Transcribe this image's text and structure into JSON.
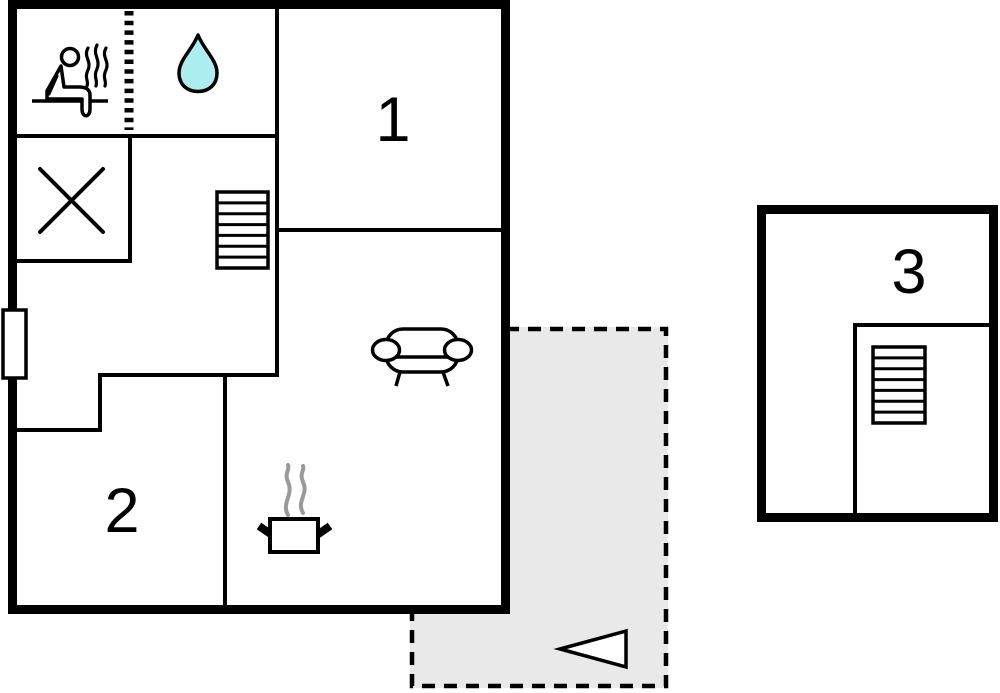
{
  "plan": {
    "type": "floor-plan",
    "rooms": [
      {
        "id": "room-1",
        "label": "1"
      },
      {
        "id": "room-2",
        "label": "2"
      },
      {
        "id": "room-3",
        "label": "3"
      }
    ],
    "features": {
      "sauna": "person-on-bench with steam",
      "bathroom": "water drop",
      "shower": "crossed square",
      "kitchen": "steaming pot",
      "living": "sofa",
      "stairs_main": "staircase",
      "stairs_annex": "staircase",
      "terrace": "dashed gray area with direction arrow",
      "window": "left wall window marker"
    },
    "colors": {
      "wall": "#000000",
      "water_drop": "#aceef0",
      "terrace": "#e9e9e9",
      "steam": "#999999",
      "background": "#ffffff"
    }
  }
}
